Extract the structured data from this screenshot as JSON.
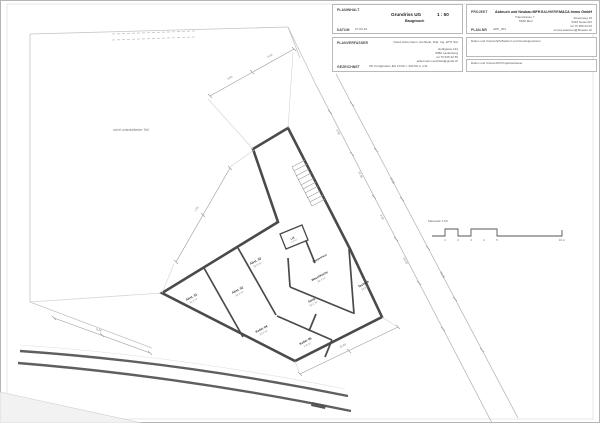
{
  "title_block": {
    "planinhalt_label": "PLANINHALT",
    "plan_title": "Grundriss UG",
    "scale": "1 : 50",
    "phase": "Baugesuch",
    "datum_label": "DATUM",
    "datum_value": "27.03.23",
    "projekt_label": "PROJEKT",
    "projekt_name": "Abbruch und Neubau MFH",
    "projekt_addr1": "Tramstrasse 7",
    "projekt_addr2": "5630 Muri",
    "plannr_label": "PLAN-NR",
    "plannr_value": "APP_001",
    "bauherr_label": "BAUHERR",
    "bauherr_name": "MACA Immo GmbH",
    "bauherr_addr1": "Rosenweg 15",
    "bauherr_addr2": "5432 Neuenhof",
    "bauherr_addr3": "tel 76 380 04 04",
    "bauherr_addr4": "emma.wassmer@bluewin.ch",
    "planverfasser_label": "PLANVERFASSER",
    "verfasser_name": "Claus Ackermann, Architekt, Dipl. Ing. ETH SIA",
    "verfasser_addr1": "Hohlgasse 134",
    "verfasser_addr2": "5080 Laufenburg",
    "verfasser_addr3": "tel 76 545 32 55",
    "verfasser_addr4": "ackermann.architekt@gmail.ch",
    "gezeichnet_label": "GEZEICHNET",
    "gezeichnet_value": "OK Fertigboden EG ±0.00 = 432.56 m ü.M.",
    "sign1": "Datum und Unterschrift Bauherr und Grundeigentümer",
    "sign2": "Datum und Unterschrift Projektverfasser"
  },
  "plan": {
    "site_note": "nicht unterkellerter Teil",
    "scalebar_label": "Massstab 1:50",
    "tick1": "1",
    "tick2": "2",
    "tick3": "3",
    "tick4": "4",
    "tick5": "5",
    "tick_end": "10 m",
    "rooms": [
      {
        "name": "Abst. 01",
        "area": "11.2 m²"
      },
      {
        "name": "Abst. 02",
        "area": "12.4 m²"
      },
      {
        "name": "Abst. 03",
        "area": "12.8 m²"
      },
      {
        "name": "Keller 04",
        "area": "15.6 m²"
      },
      {
        "name": "Keller 05",
        "area": "9.8 m²"
      },
      {
        "name": "Gang",
        "area": "12.2 m²"
      },
      {
        "name": "Waschküche",
        "area": "16.4 m²"
      },
      {
        "name": "Technik",
        "area": "18.6 m²"
      },
      {
        "name": "Lift",
        "area": "3.4 m²"
      },
      {
        "name": "Treppenhaus",
        "area": ""
      }
    ],
    "dim_values": [
      "3.85",
      "5.04",
      "7.25",
      "4.50",
      "12.36",
      "3.85",
      "15.20",
      "24.65",
      "18.40",
      "15.60",
      "8.20"
    ]
  }
}
